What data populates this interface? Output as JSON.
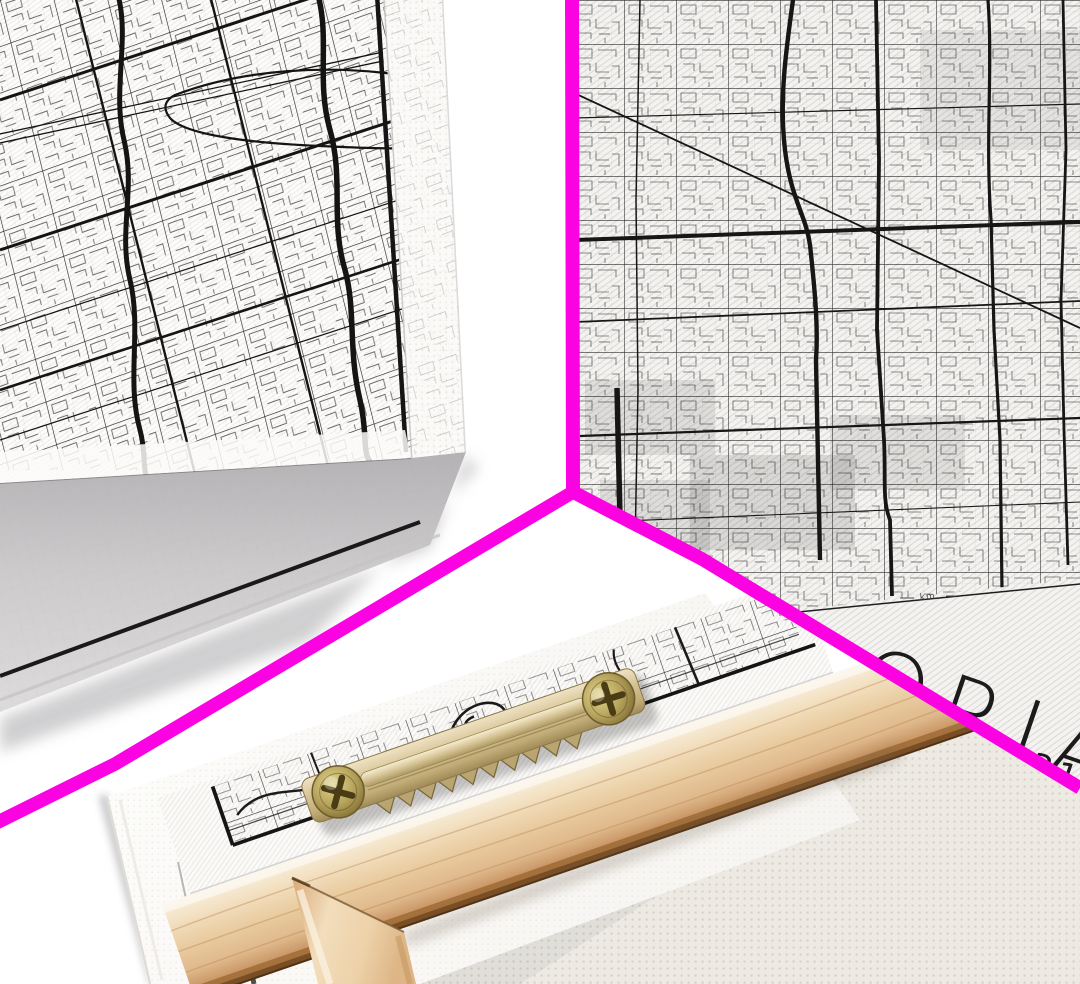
{
  "photo": {
    "description": "Three-view product photo collage of a black and white city street map canvas print",
    "views": {
      "corner": {
        "label": "angled corner view of stretched canvas"
      },
      "detail": {
        "title_fragment": "ORIA",
        "coordinates_fragment": "231",
        "scale_label": "km"
      },
      "back": {
        "label": "back view with wooden stretcher frame and sawtooth hanger"
      }
    }
  },
  "colors": {
    "divider": "#FA02E2",
    "background": "#FFFFFF",
    "map_ink": "#1A1A1A",
    "canvas_weave": "#DCD8D4",
    "wood_light": "#F8EEDC",
    "wood_mid": "#E9C9A0",
    "wood_dark": "#8F5E31",
    "brass_light": "#EFE3C4",
    "brass_mid": "#C9B583",
    "brass_dark": "#6E5C38",
    "canvas_back": "#ECE8E2",
    "shadow": "#ABABAF"
  }
}
